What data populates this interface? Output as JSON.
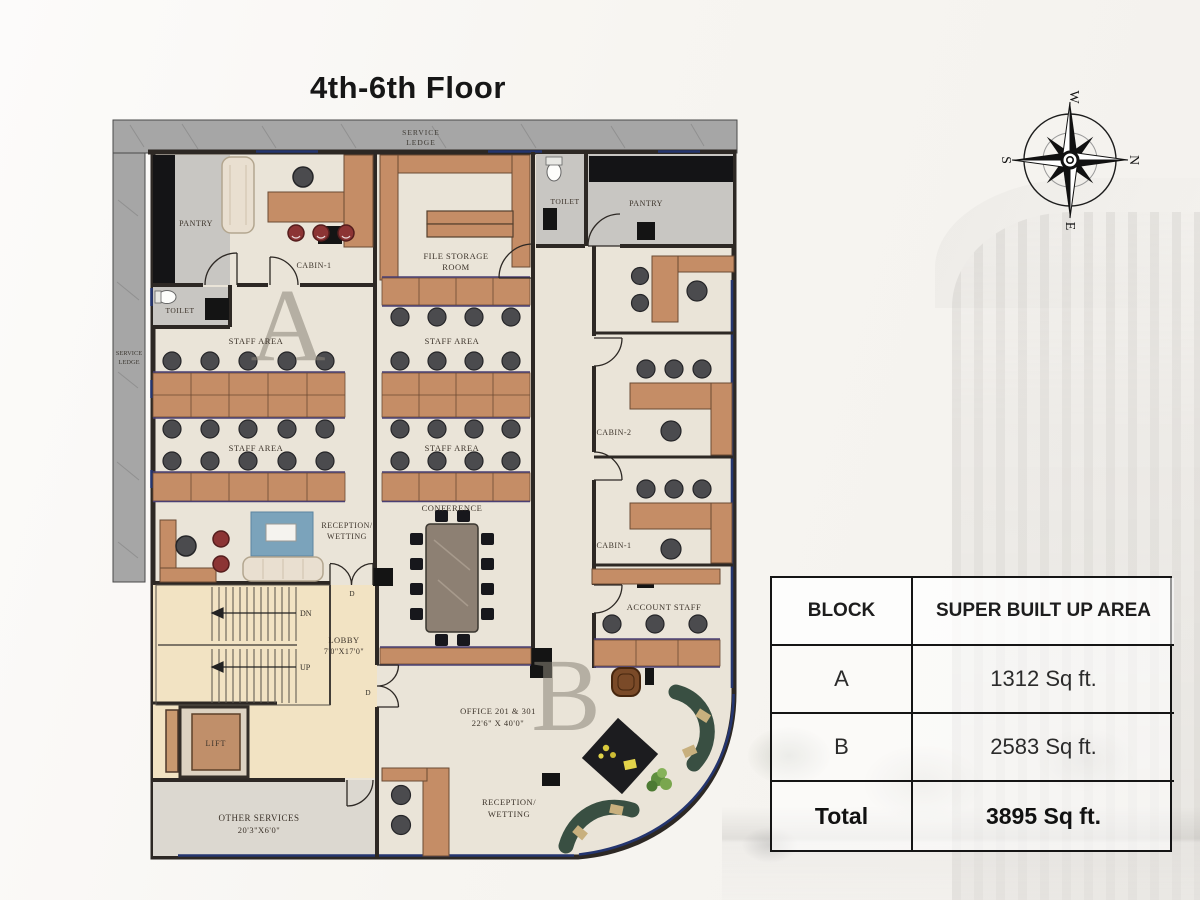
{
  "title": "4th-6th Floor",
  "compass": {
    "north": "N",
    "south": "S",
    "east": "E",
    "west": "W"
  },
  "plan": {
    "labels": {
      "service_ledge": [
        "SERVICE",
        "LEDGE"
      ],
      "pantry": "PANTRY",
      "toilet": "TOILET",
      "cabin1": "CABIN-1",
      "cabin2": "CABIN-2",
      "staff_area": "STAFF AREA",
      "reception_wetting": [
        "RECEPTION/",
        "WETTING"
      ],
      "file_storage": [
        "FILE STORAGE",
        "ROOM"
      ],
      "conference": "CONFERENCE",
      "account_staff": "ACCOUNT STAFF",
      "lobby": [
        "LOBBY",
        "7'0\"X17'0\""
      ],
      "lift": "LIFT",
      "other_services": [
        "OTHER SERVICES",
        "20'3\"X6'0\""
      ],
      "office": [
        "OFFICE 201 & 301",
        "22'6\" X 40'0\""
      ],
      "dn": "DN",
      "up": "UP",
      "door": "D",
      "block_a": "A",
      "block_b": "B"
    }
  },
  "area_table": {
    "headers": [
      "BLOCK",
      "SUPER BUILT UP AREA"
    ],
    "rows": [
      {
        "block": "A",
        "area": "1312 Sq ft."
      },
      {
        "block": "B",
        "area": "2583 Sq ft."
      },
      {
        "block": "Total",
        "area": "3895 Sq ft."
      }
    ]
  },
  "colors": {
    "floor": "#eae4d8",
    "lobby_floor": "#f2e3c3",
    "desk_tan": "#c58d66",
    "wall": "#2d2824",
    "glazing_blue": "#24356f",
    "desk_trim_purple": "#4a3f73",
    "stool_red": "#8c3434",
    "rug_blue": "#7ba3bb",
    "sofa_green": "#394f42",
    "marble_gray": "#c8c6c2",
    "marble_black": "#141416",
    "ledge_gray": "#a6a6a6",
    "table_border": "#151515"
  }
}
